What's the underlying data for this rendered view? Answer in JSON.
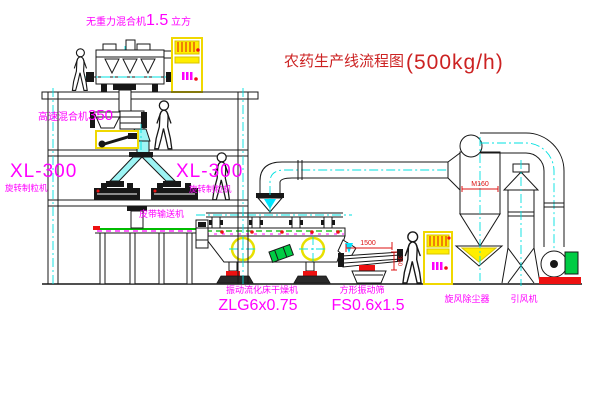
{
  "title": {
    "name": "农药生产线流程图",
    "capacity": "(500kg/h)"
  },
  "equipment": {
    "gravity_mixer": {
      "label": "无重力混合机",
      "size": "1.5",
      "unit": " 立方"
    },
    "high_speed_mixer": {
      "label": "高速混合机",
      "size": "350"
    },
    "granulator_left": {
      "model": "XL-300",
      "name": "旋转制粒机"
    },
    "granulator_right": {
      "model": "XL-300",
      "name": "旋转制粒机"
    },
    "belt_conveyor": {
      "name": "皮带输送机"
    },
    "fluid_bed_dryer": {
      "name": "振动流化床干燥机",
      "model": "ZLG6x0.75"
    },
    "square_sieve": {
      "name": "方形振动筛",
      "model": "FS0.6x1.5"
    },
    "cyclone": {
      "name": "旋风除尘器",
      "dim": "M160"
    },
    "fan": {
      "name": "引风机"
    }
  },
  "dimensions": {
    "sieve_width": "1500",
    "sieve_height": "350"
  },
  "colors": {
    "label_magenta": "#ff00ff",
    "title_red": "#cc2222",
    "centerline_cyan": "#00e0e0",
    "highlight_yellow": "#f0d800",
    "conveyor_green": "#00bb00",
    "marker_red": "#ee1111"
  }
}
